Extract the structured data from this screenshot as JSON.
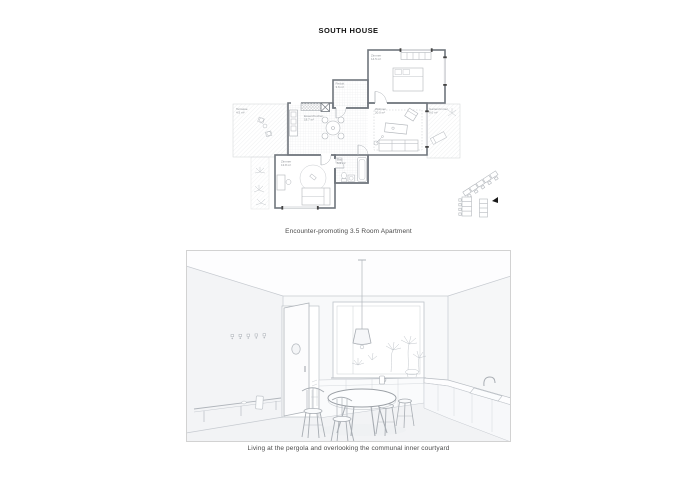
{
  "page": {
    "title": "SOUTH HOUSE"
  },
  "plan": {
    "caption": "Encounter-promoting 3.5 Room Apartment",
    "rooms": [
      {
        "name": "Zimmer",
        "area": "14.5 m²"
      },
      {
        "name": "Reduit",
        "area": "3.6 m²"
      },
      {
        "name": "Essen/Kochen",
        "area": "18.7 m²"
      },
      {
        "name": "Wohnen",
        "area": "20.0 m²"
      },
      {
        "name": "Terrasse",
        "area": "4.5 m²"
      },
      {
        "name": "Gartenzimmer",
        "area": "9.0 m²"
      },
      {
        "name": "Zimmer",
        "area": "13.8 m²"
      },
      {
        "name": "Bad",
        "area": "5.5 m²"
      }
    ]
  },
  "render": {
    "caption": "Living at the pergola and overlooking the communal inner courtyard"
  },
  "colors": {
    "background": "#ffffff",
    "wall_line": "#70767d",
    "furniture_line": "#b2b6bb",
    "caption_text": "#4b4b4b",
    "site_marker": "#191919"
  }
}
